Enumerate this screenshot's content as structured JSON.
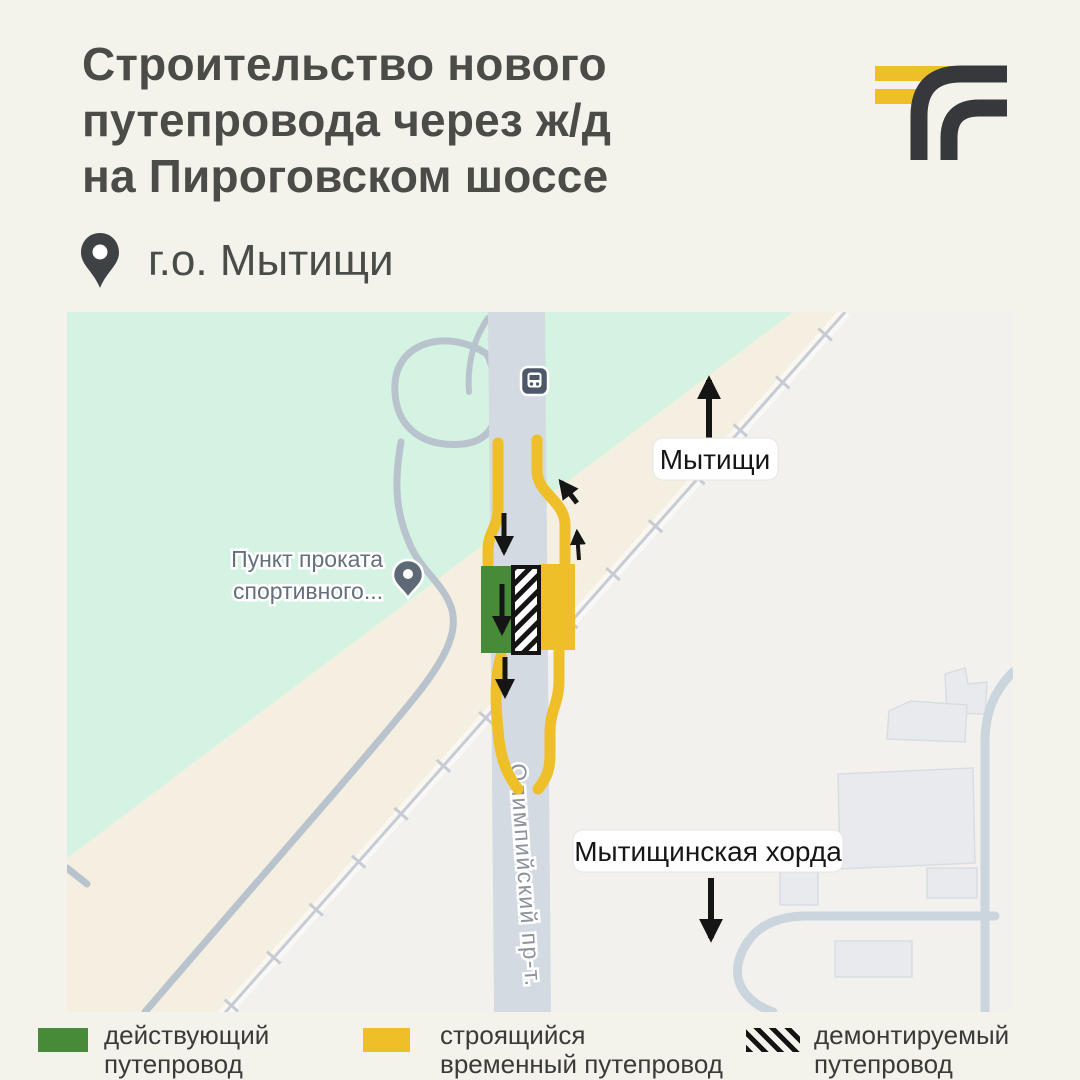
{
  "header": {
    "title_lines": [
      "Строительство нового",
      "путепровода через ж/д",
      "на Пироговском шоссе"
    ],
    "location_label": "г.о. Мытищи"
  },
  "map": {
    "city_label": "Мытищи",
    "khorda_label": "Мытищинская хорда",
    "road_label": "Олимпийский пр-т.",
    "poi_label_line1": "Пункт проката",
    "poi_label_line2": "спортивного...",
    "icons": [
      "transit-stop-icon",
      "poi-pin-icon",
      "direction-arrows"
    ]
  },
  "legend": {
    "items": [
      {
        "swatch": "green-rect",
        "line1": "действующий",
        "line2": "путепровод"
      },
      {
        "swatch": "yellow-rect",
        "line1": "строящийся",
        "line2": "временный путепровод"
      },
      {
        "swatch": "hatched-rect",
        "line1": "демонтируемый",
        "line2": "путепровод"
      }
    ]
  },
  "colors": {
    "background": "#f4f3eb",
    "title_text": "#4b4b47",
    "accent_yellow": "#efbf2a",
    "bridge_green": "#478b38",
    "logo_dark": "#37383c",
    "map_park_green": "#d5f3e2",
    "map_beige": "#f5efe1",
    "map_offmap_gray": "#f2f1ee",
    "map_road_gray": "#d3dae1"
  }
}
